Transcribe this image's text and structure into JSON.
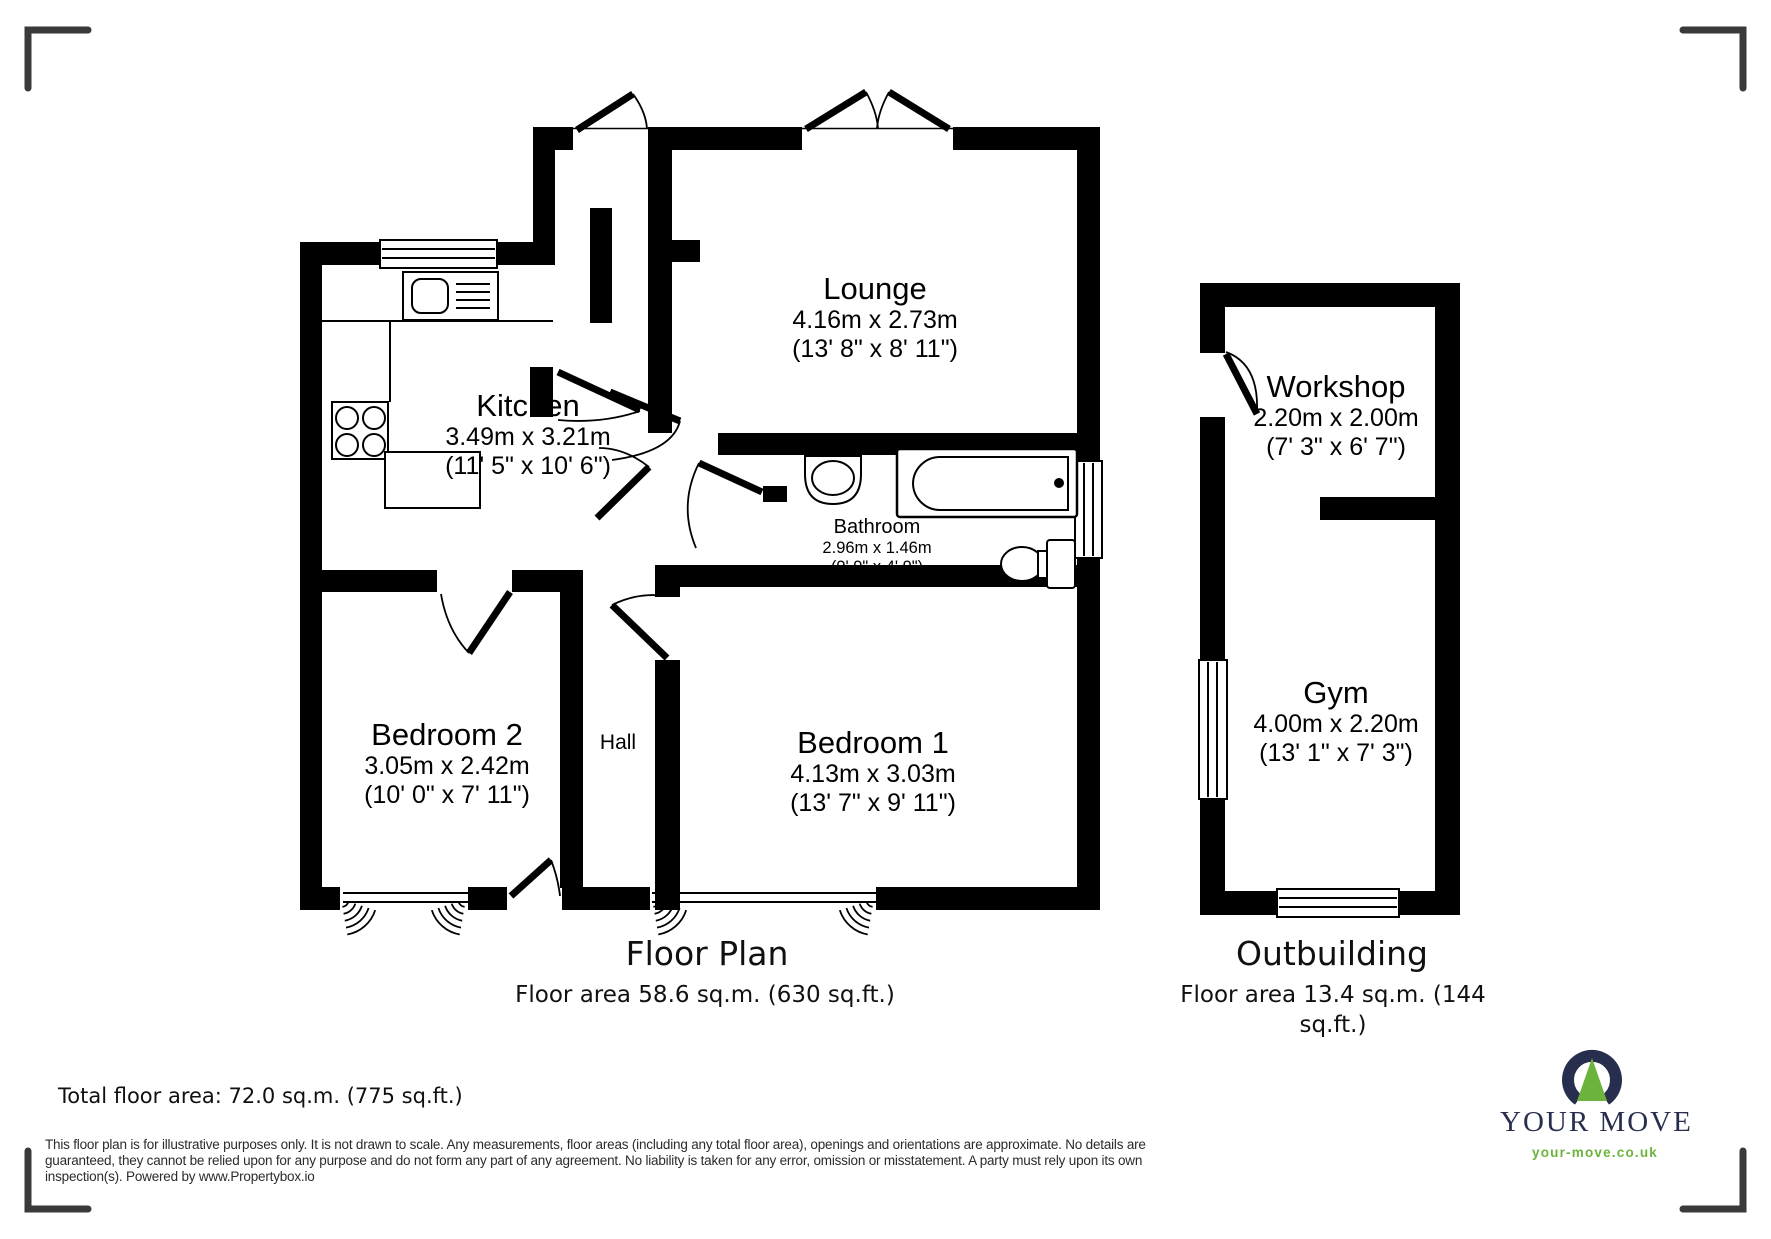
{
  "floor_plan": {
    "title": "Floor Plan",
    "area_caption": "Floor area 58.6 sq.m. (630 sq.ft.)",
    "rooms": {
      "lounge": {
        "name": "Lounge",
        "metric": "4.16m x 2.73m",
        "imperial": "(13' 8\" x 8' 11\")"
      },
      "kitchen": {
        "name": "Kitchen",
        "metric": "3.49m x 3.21m",
        "imperial": "(11' 5\" x 10' 6\")"
      },
      "bathroom": {
        "name": "Bathroom",
        "metric": "2.96m x 1.46m",
        "imperial": "(9' 9\" x 4' 9\")"
      },
      "bedroom2": {
        "name": "Bedroom 2",
        "metric": "3.05m x 2.42m",
        "imperial": "(10' 0\" x 7' 11\")"
      },
      "bedroom1": {
        "name": "Bedroom 1",
        "metric": "4.13m x 3.03m",
        "imperial": "(13' 7\" x 9' 11\")"
      },
      "hall": {
        "name": "Hall"
      }
    }
  },
  "outbuilding": {
    "title": "Outbuilding",
    "area_caption_line1": "Floor area 13.4 sq.m. (144",
    "area_caption_line2": "sq.ft.)",
    "rooms": {
      "workshop": {
        "name": "Workshop",
        "metric": "2.20m x 2.00m",
        "imperial": "(7' 3\" x 6' 7\")"
      },
      "gym": {
        "name": "Gym",
        "metric": "4.00m x 2.20m",
        "imperial": "(13' 1\" x 7' 3\")"
      }
    }
  },
  "summary": {
    "total_area": "Total floor area: 72.0 sq.m. (775 sq.ft.)"
  },
  "disclaimer": {
    "line1": "This floor plan is for illustrative purposes only. It is not drawn to scale. Any measurements, floor areas (including any total floor area), openings and orientations are approximate. No details are",
    "line2": "guaranteed, they cannot be relied upon for any purpose and do not form any part of any agreement. No liability is taken for any error, omission or misstatement. A party must rely upon its own",
    "line3": "inspection(s). Powered by www.Propertybox.io"
  },
  "logo": {
    "brand": "YOUR MOVE",
    "website": "your-move.co.uk",
    "colors": {
      "navy": "#282f4e",
      "green": "#6cb33e"
    }
  }
}
